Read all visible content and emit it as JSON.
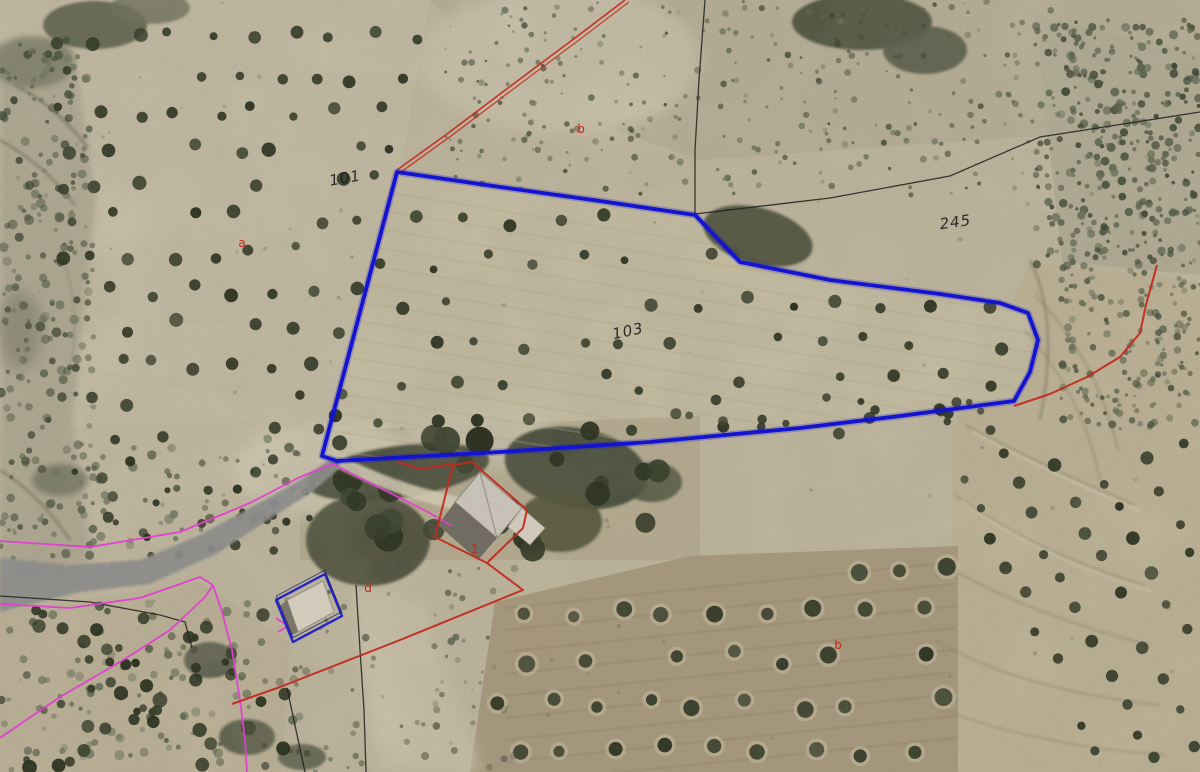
{
  "map": {
    "kind": "aerial-orthophoto-cadastral-viewer",
    "colors": {
      "parcel_outline_blue": "#1313d0",
      "boundary_red": "#c32a1e",
      "boundary_magenta": "#e23ed2",
      "boundary_black": "#1e1e1e",
      "road_overlay_gray": "#8d8d8d",
      "label_black": "#1b1b1b",
      "label_red": "#c0281e"
    },
    "parcel_labels": [
      {
        "id": "101",
        "text": "101",
        "x": 346,
        "y": 183,
        "rotation": -10
      },
      {
        "id": "103",
        "text": "103",
        "x": 629,
        "y": 336,
        "rotation": -12
      },
      {
        "id": "245",
        "text": "245",
        "x": 956,
        "y": 227,
        "rotation": -8
      }
    ],
    "subparcel_labels": [
      {
        "id": "a",
        "text": "a",
        "x": 242,
        "y": 247
      },
      {
        "id": "b-top",
        "text": "b",
        "x": 581,
        "y": 133
      },
      {
        "id": "b-bottom",
        "text": "b",
        "x": 838,
        "y": 649
      },
      {
        "id": "d",
        "text": "d",
        "x": 368,
        "y": 592
      },
      {
        "id": "1",
        "text": "1",
        "x": 475,
        "y": 553
      }
    ],
    "overlays": {
      "selected_parcel_polygon": {
        "closed": true,
        "points": [
          [
            397,
            172
          ],
          [
            500,
            187
          ],
          [
            600,
            201
          ],
          [
            695,
            215
          ],
          [
            740,
            262
          ],
          [
            830,
            280
          ],
          [
            940,
            294
          ],
          [
            1000,
            303
          ],
          [
            1028,
            313
          ],
          [
            1038,
            340
          ],
          [
            1030,
            372
          ],
          [
            1014,
            401
          ],
          [
            900,
            416
          ],
          [
            800,
            428
          ],
          [
            650,
            442
          ],
          [
            500,
            452
          ],
          [
            337,
            461
          ],
          [
            322,
            456
          ]
        ]
      },
      "selected_building_polygon": {
        "closed": true,
        "points": [
          [
            276,
            600
          ],
          [
            325,
            574
          ],
          [
            342,
            616
          ],
          [
            293,
            642
          ]
        ]
      },
      "red_lines": [
        {
          "id": "boundary-northeast",
          "double": true,
          "points": [
            [
              397,
              170
            ],
            [
              447,
              134
            ],
            [
              520,
              79
            ],
            [
              575,
              38
            ],
            [
              625,
              0
            ]
          ]
        },
        {
          "id": "boundary-east",
          "points": [
            [
              1157,
              265
            ],
            [
              1146,
              305
            ],
            [
              1140,
              333
            ],
            [
              1120,
              357
            ],
            [
              1087,
              377
            ],
            [
              1050,
              394
            ],
            [
              1014,
              406
            ]
          ]
        },
        {
          "id": "building-outline",
          "closed": true,
          "points": [
            [
              472,
              462
            ],
            [
              527,
              510
            ],
            [
              523,
              528
            ],
            [
              487,
              563
            ],
            [
              435,
              537
            ],
            [
              453,
              465
            ]
          ]
        },
        {
          "id": "boundary-farmyard",
          "points": [
            [
              398,
              462
            ],
            [
              420,
              469
            ],
            [
              453,
              464
            ]
          ]
        },
        {
          "id": "boundary-south",
          "points": [
            [
              487,
              563
            ],
            [
              523,
              590
            ],
            [
              400,
              640
            ],
            [
              280,
              687
            ],
            [
              232,
              704
            ]
          ]
        }
      ],
      "magenta_lines": [
        {
          "id": "road-north-edge",
          "points": [
            [
              0,
              541
            ],
            [
              90,
              547
            ],
            [
              180,
              532
            ],
            [
              250,
              503
            ],
            [
              300,
              477
            ],
            [
              333,
              464
            ],
            [
              380,
              488
            ],
            [
              428,
              512
            ],
            [
              452,
              526
            ]
          ]
        },
        {
          "id": "road-south-edge",
          "points": [
            [
              0,
              604
            ],
            [
              70,
              608
            ],
            [
              140,
              598
            ],
            [
              200,
              577
            ],
            [
              213,
              585
            ]
          ]
        },
        {
          "id": "slope-west",
          "points": [
            [
              0,
              738
            ],
            [
              60,
              697
            ],
            [
              120,
              662
            ],
            [
              170,
              630
            ],
            [
              205,
              597
            ],
            [
              213,
              585
            ]
          ]
        },
        {
          "id": "slope-south",
          "points": [
            [
              213,
              585
            ],
            [
              222,
              612
            ],
            [
              232,
              650
            ],
            [
              240,
              700
            ],
            [
              245,
              740
            ],
            [
              247,
              772
            ]
          ]
        },
        {
          "id": "small-mark",
          "points": [
            [
              276,
              618
            ],
            [
              288,
              626
            ],
            [
              278,
              632
            ]
          ]
        }
      ],
      "black_lines": [
        {
          "id": "north",
          "points": [
            [
              705,
              0
            ],
            [
              699,
              80
            ],
            [
              695,
              150
            ],
            [
              695,
              214
            ]
          ]
        },
        {
          "id": "northeast",
          "points": [
            [
              695,
              214
            ],
            [
              830,
              198
            ],
            [
              950,
              176
            ],
            [
              1040,
              137
            ],
            [
              1200,
              112
            ]
          ]
        },
        {
          "id": "road-edge-west",
          "points": [
            [
              0,
              596
            ],
            [
              90,
              602
            ],
            [
              160,
              615
            ],
            [
              185,
              622
            ],
            [
              192,
              648
            ]
          ]
        },
        {
          "id": "field-center",
          "points": [
            [
              356,
              585
            ],
            [
              360,
              650
            ],
            [
              364,
              710
            ],
            [
              366,
              772
            ]
          ]
        },
        {
          "id": "field-west",
          "points": [
            [
              287,
              688
            ],
            [
              296,
              730
            ],
            [
              305,
              772
            ]
          ]
        }
      ],
      "road_polygon": {
        "points": [
          [
            0,
            558
          ],
          [
            70,
            565
          ],
          [
            140,
            560
          ],
          [
            200,
            535
          ],
          [
            250,
            508
          ],
          [
            300,
            480
          ],
          [
            332,
            458
          ],
          [
            340,
            468
          ],
          [
            312,
            492
          ],
          [
            262,
            524
          ],
          [
            216,
            554
          ],
          [
            150,
            584
          ],
          [
            80,
            592
          ],
          [
            0,
            612
          ]
        ]
      }
    }
  }
}
